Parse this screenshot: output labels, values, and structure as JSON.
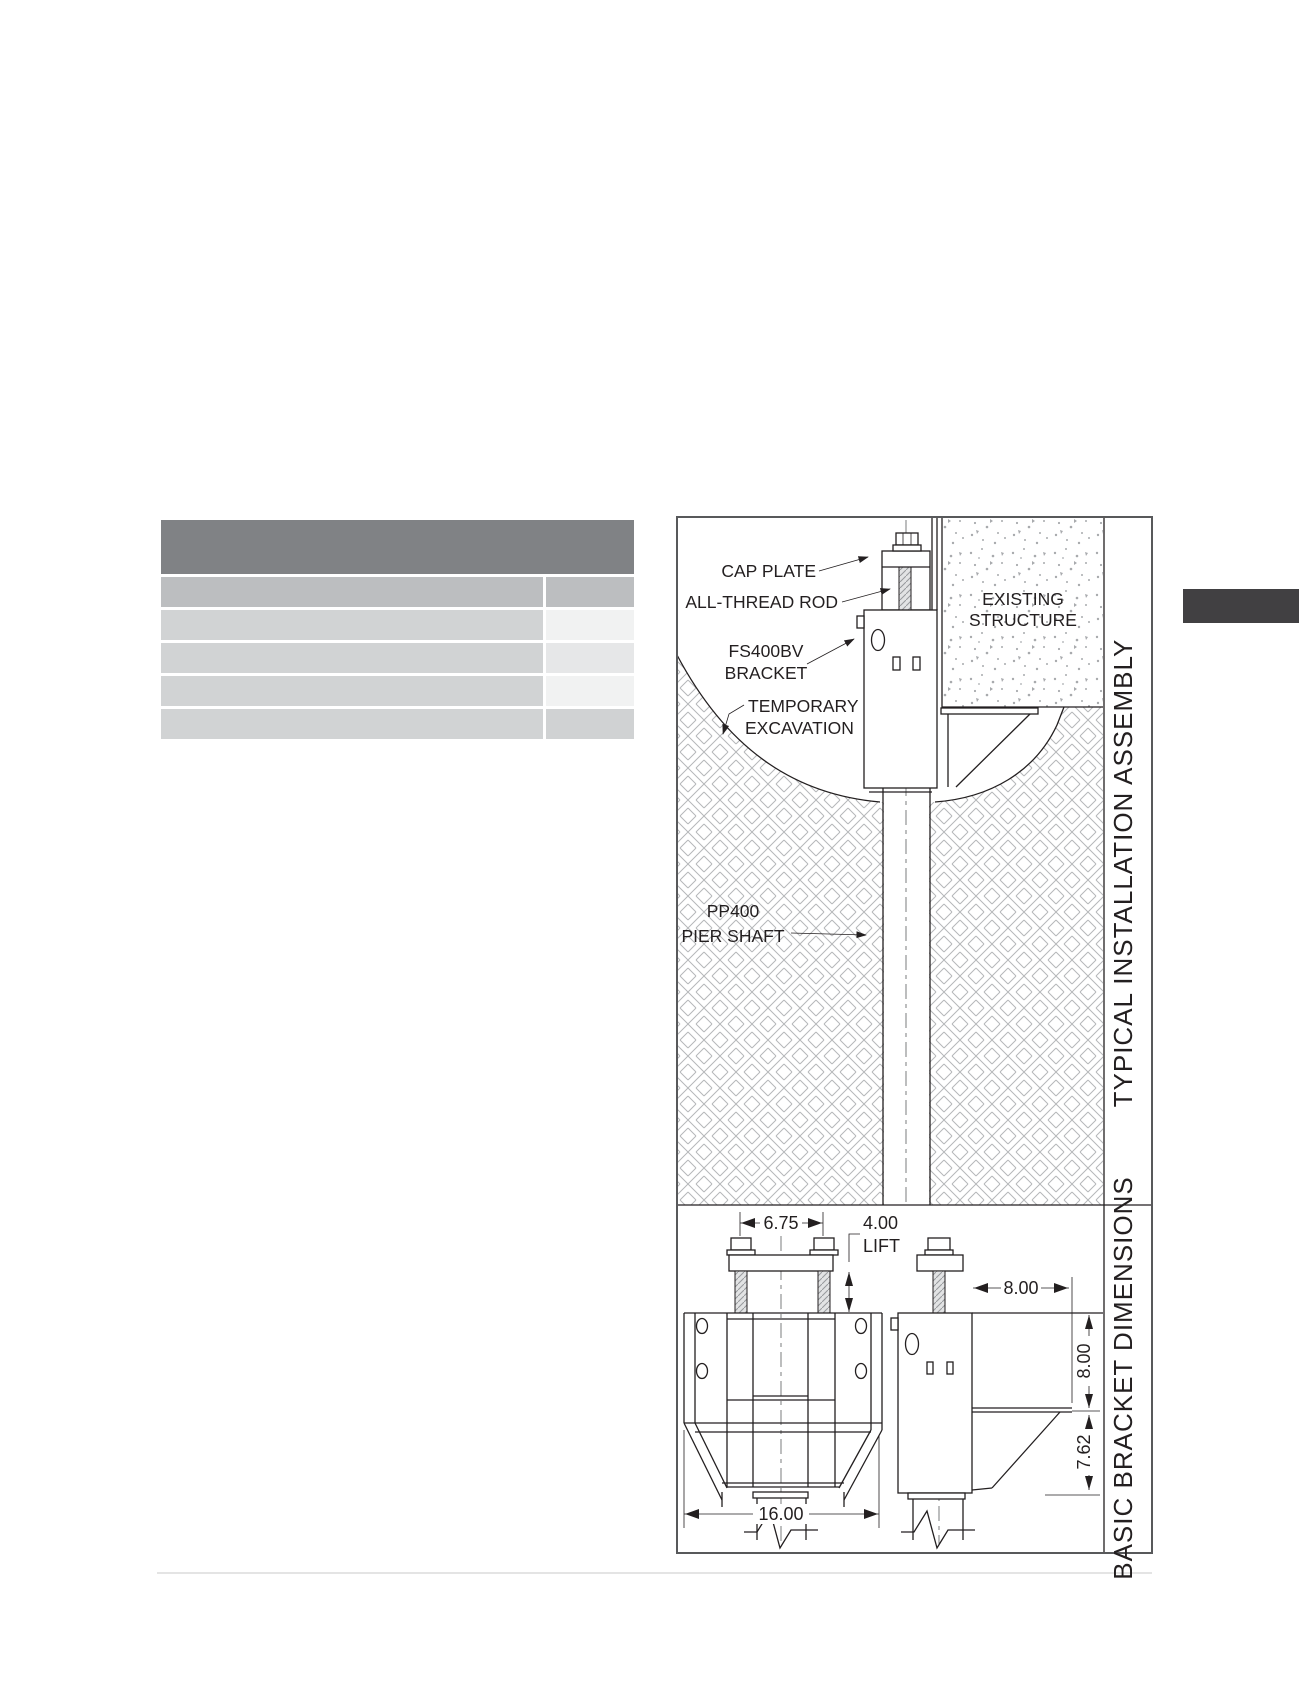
{
  "spec_table": {
    "note": "empty placeholder table, no visible text",
    "row_count": 5,
    "column_count": 2,
    "colors": {
      "header": "#808285",
      "row_medium": "#bcbec0",
      "row_light": "#d1d3d4",
      "cell_pale": "#f1f2f2"
    }
  },
  "accent_bar_color": "#414042",
  "diagram": {
    "sections": [
      {
        "title": "TYPICAL INSTALLATION ASSEMBLY"
      },
      {
        "title": "BASIC BRACKET DIMENSIONS"
      }
    ],
    "assembly_labels": {
      "cap_plate": "CAP PLATE",
      "all_thread_rod": "ALL-THREAD ROD",
      "bracket_line1": "FS400BV",
      "bracket_line2": "BRACKET",
      "excavation_line1": "TEMPORARY",
      "excavation_line2": "EXCAVATION",
      "structure_line1": "EXISTING",
      "structure_line2": "STRUCTURE",
      "pier_line1": "PP400",
      "pier_line2": "PIER SHAFT"
    },
    "dimensions": {
      "bolt_spacing": "6.75",
      "lift_value": "4.00",
      "lift_label": "LIFT",
      "plate_depth": "8.00",
      "bracket_height": "8.00",
      "seat_depth": "7.62",
      "bracket_width": "16.00"
    }
  }
}
